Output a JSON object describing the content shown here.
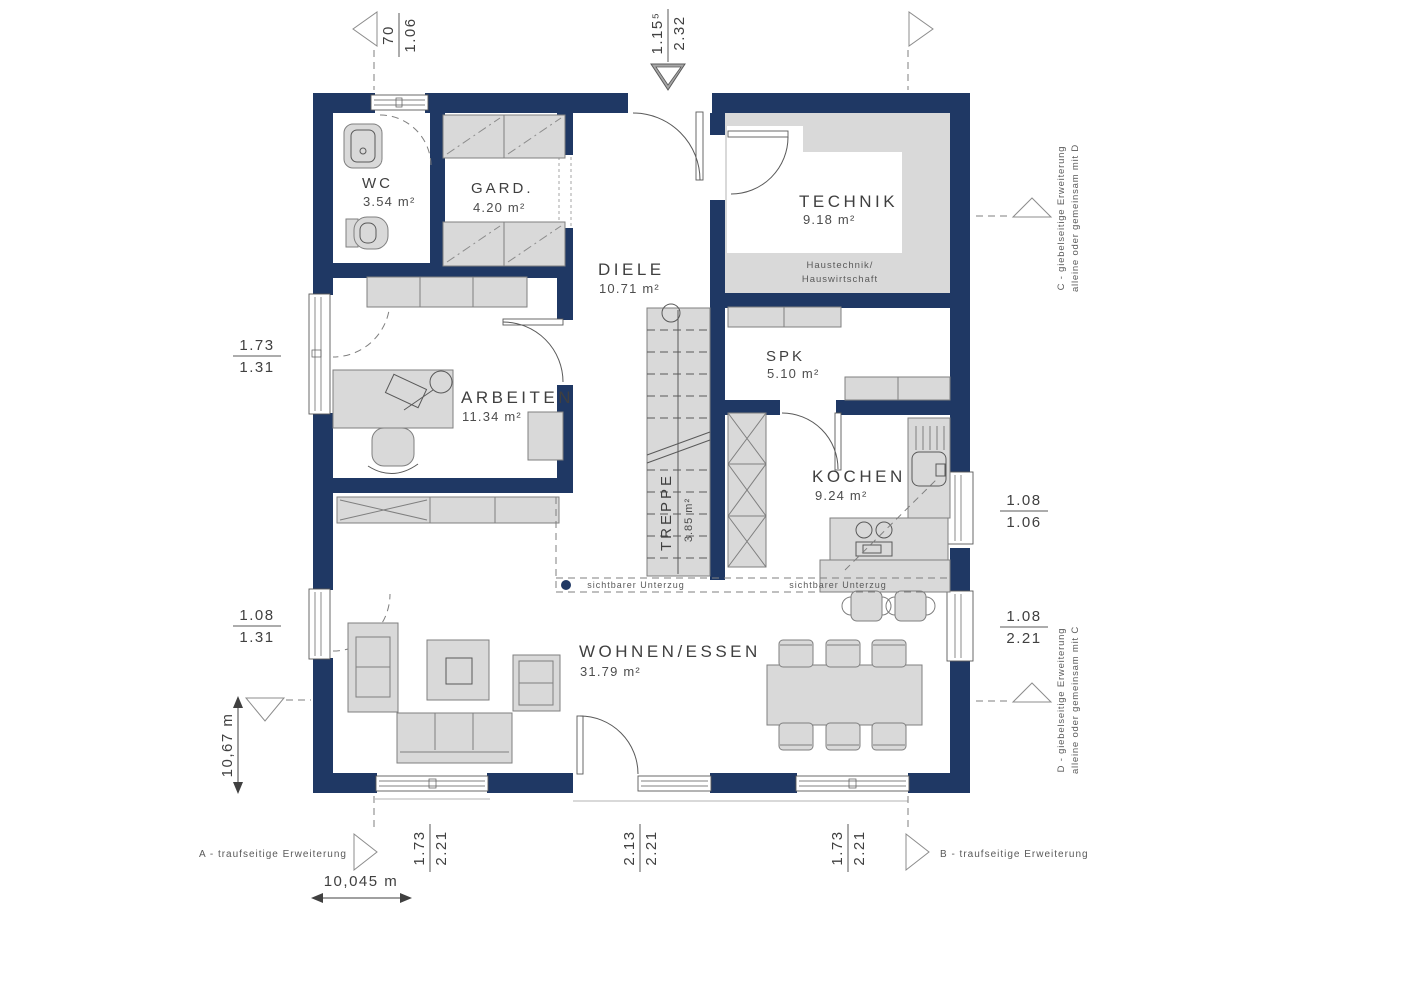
{
  "rooms": {
    "wc": {
      "name": "WC",
      "area": "3.54 m²"
    },
    "gard": {
      "name": "GARD.",
      "area": "4.20 m²"
    },
    "diele": {
      "name": "DIELE",
      "area": "10.71 m²"
    },
    "technik": {
      "name": "TECHNIK",
      "area": "9.18 m²",
      "note1": "Haustechnik/",
      "note2": "Hauswirtschaft"
    },
    "spk": {
      "name": "SPK",
      "area": "5.10 m²"
    },
    "arbeiten": {
      "name": "ARBEITEN",
      "area": "11.34 m²"
    },
    "kochen": {
      "name": "KOCHEN",
      "area": "9.24 m²"
    },
    "treppe": {
      "name": "TREPPE",
      "area": "3.85 m²"
    },
    "wohnen_essen": {
      "name": "WOHNEN/ESSEN",
      "area": "31.79 m²"
    }
  },
  "dimensions": {
    "top_left": {
      "num": "70",
      "den": "1.06"
    },
    "top_entry": {
      "num": "1.15⁵",
      "den": "2.32"
    },
    "left_upper": {
      "num": "1.73",
      "den": "1.31"
    },
    "left_lower": {
      "num": "1.08",
      "den": "1.31"
    },
    "right_upper": {
      "num": "1.08",
      "den": "1.06"
    },
    "right_lower": {
      "num": "1.08",
      "den": "2.21"
    },
    "bottom_left": {
      "num": "1.73",
      "den": "2.21"
    },
    "bottom_center": {
      "num": "2.13",
      "den": "2.21"
    },
    "bottom_right": {
      "num": "1.73",
      "den": "2.21"
    },
    "height_total": "10,67 m",
    "width_total": "10,045 m"
  },
  "annotations": {
    "unterzug": "sichtbarer Unterzug",
    "ext_a": "A - traufseitige Erweiterung",
    "ext_b": "B - traufseitige Erweiterung",
    "ext_c1": "C - giebelseitige Erweiterung",
    "ext_c2": "alleine oder gemeinsam mit D",
    "ext_d1": "D - giebelseitige Erweiterung",
    "ext_d2": "alleine oder gemeinsam mit C"
  },
  "colors": {
    "wall": "#1f3864",
    "furniture": "#d9d9d9",
    "line": "#595959",
    "text": "#404040",
    "background": "#ffffff"
  }
}
